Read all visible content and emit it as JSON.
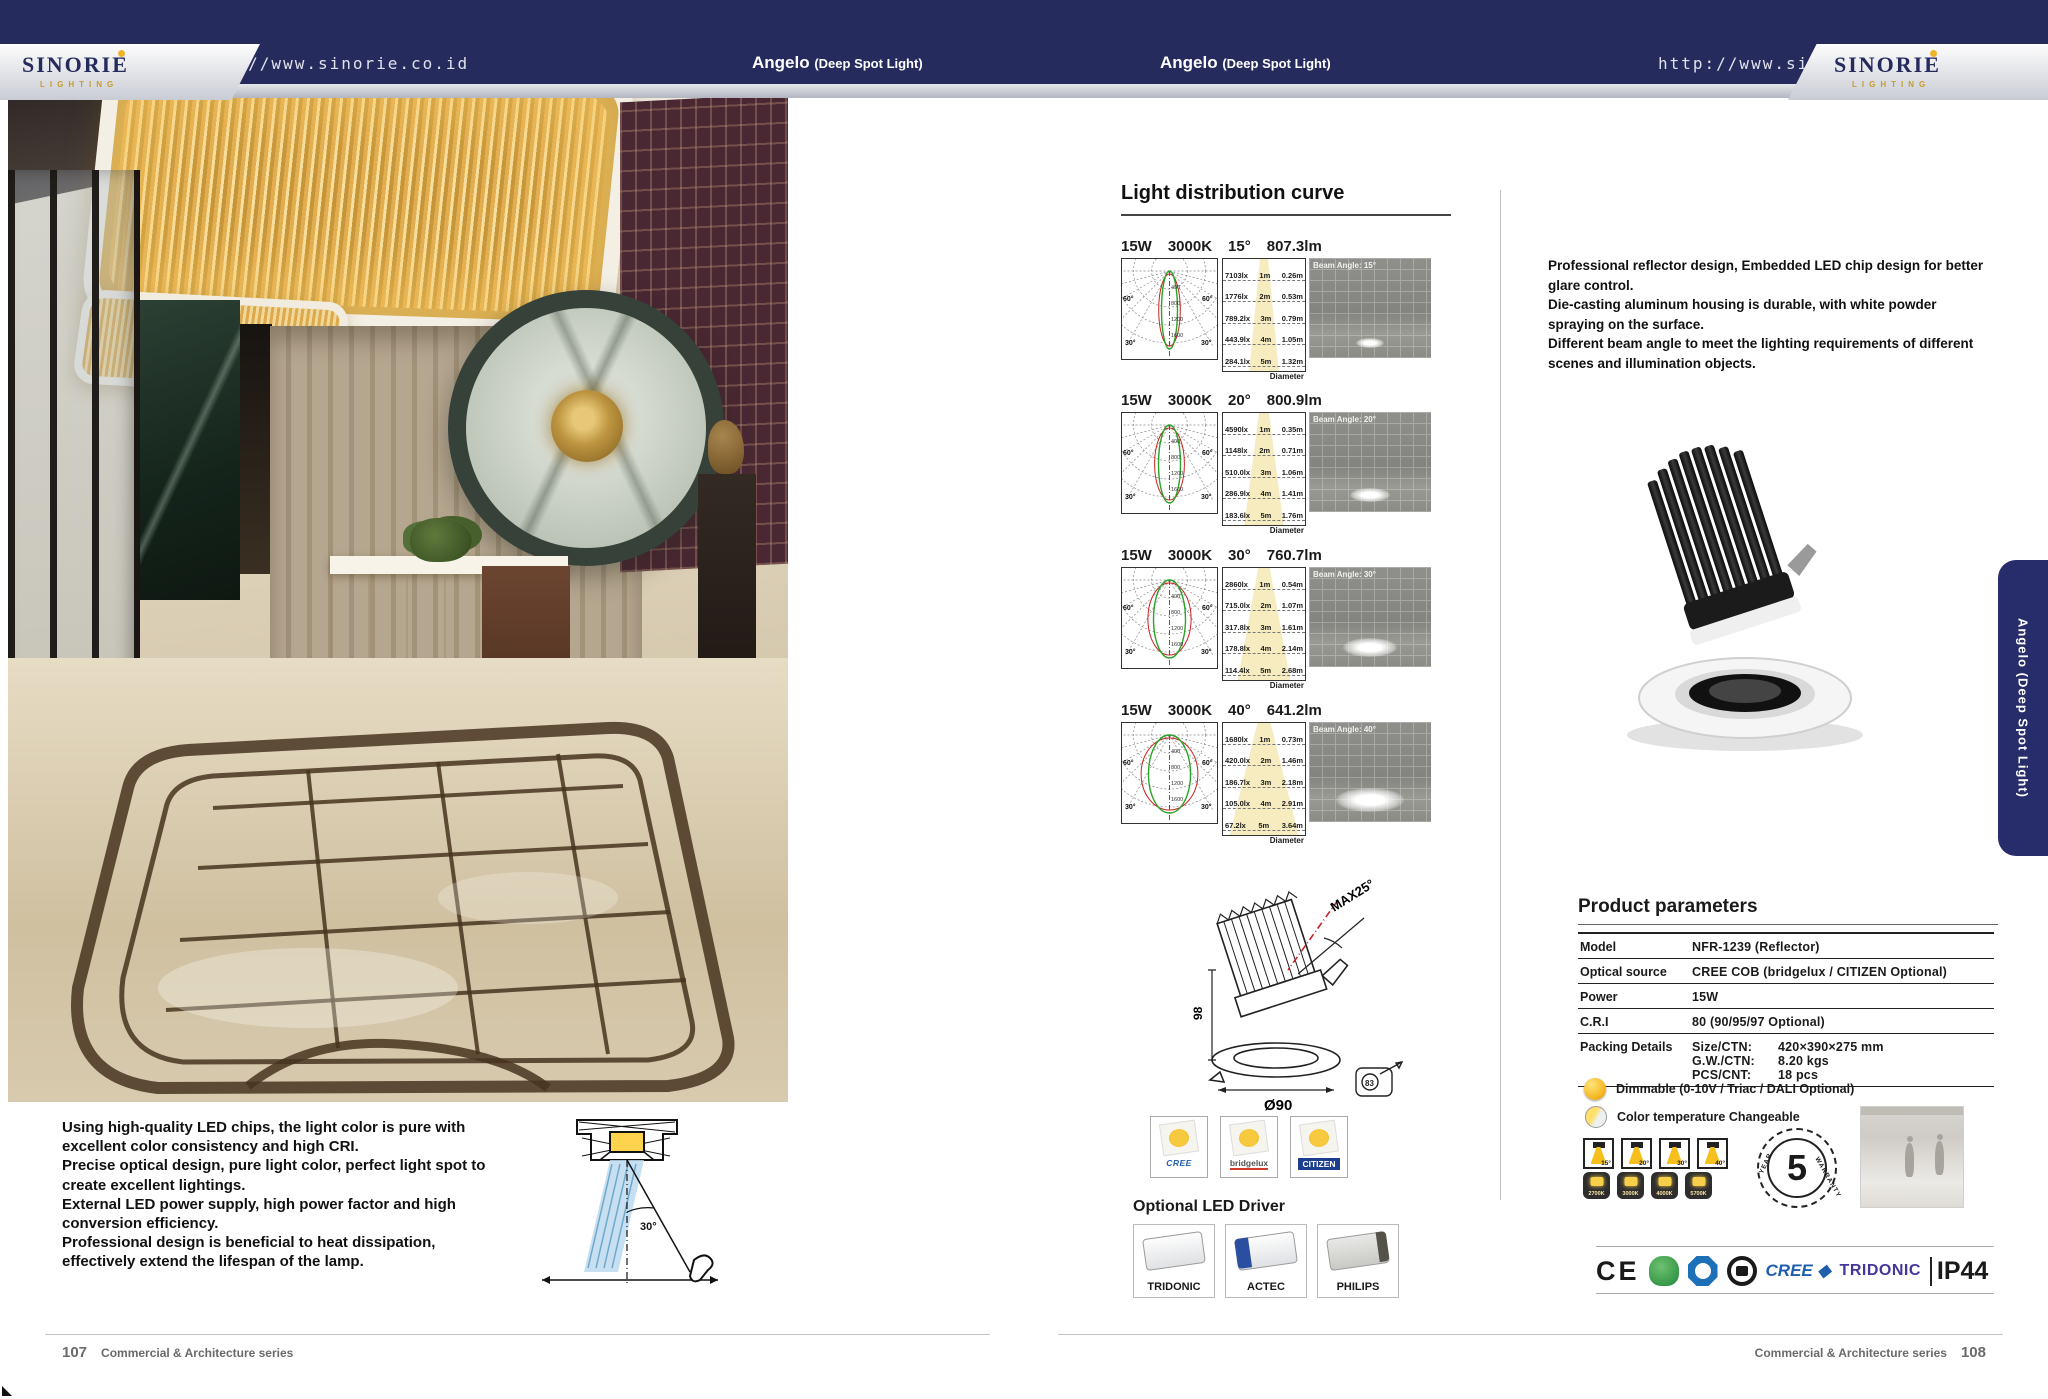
{
  "brand": {
    "name": "SINORIE",
    "tagline": "LIGHTING",
    "url": "http://www.sinorie.co.id"
  },
  "product": {
    "name": "Angelo",
    "type": "(Deep Spot Light)"
  },
  "side_tab": "Angelo (Deep Spot Light)",
  "footer": {
    "left_page_no": "107",
    "right_page_no": "108",
    "series": "Commercial & Architecture series"
  },
  "left_page": {
    "features": [
      "Using high-quality LED chips, the light color is pure with excellent color consistency and high CRI.",
      "Precise optical design, pure light color, perfect light spot to create excellent lightings.",
      "External LED power supply, high power factor and high conversion efficiency.",
      "Professional design is beneficial to heat dissipation, effectively extend the lifespan of the lamp."
    ],
    "glare_angle": "30°"
  },
  "distribution": {
    "title": "Light distribution curve",
    "diameter_label": "Diameter",
    "polar_ticks": [
      "400",
      "800",
      "1200",
      "1600"
    ],
    "polar_angle_labels": [
      "60°",
      "30°"
    ],
    "rows": [
      {
        "power": "15W",
        "cct": "3000K",
        "angle": "15°",
        "lumens": "807.3lm",
        "beam_label": "Beam Angle: 15°",
        "cone_table": [
          [
            "7103lx",
            "1m",
            "0.26m"
          ],
          [
            "1776lx",
            "2m",
            "0.53m"
          ],
          [
            "789.2lx",
            "3m",
            "0.79m"
          ],
          [
            "443.9lx",
            "4m",
            "1.05m"
          ],
          [
            "284.1lx",
            "5m",
            "1.32m"
          ]
        ]
      },
      {
        "power": "15W",
        "cct": "3000K",
        "angle": "20°",
        "lumens": "800.9lm",
        "beam_label": "Beam Angle: 20°",
        "cone_table": [
          [
            "4590lx",
            "1m",
            "0.35m"
          ],
          [
            "1148lx",
            "2m",
            "0.71m"
          ],
          [
            "510.0lx",
            "3m",
            "1.06m"
          ],
          [
            "286.9lx",
            "4m",
            "1.41m"
          ],
          [
            "183.6lx",
            "5m",
            "1.76m"
          ]
        ]
      },
      {
        "power": "15W",
        "cct": "3000K",
        "angle": "30°",
        "lumens": "760.7lm",
        "beam_label": "Beam Angle: 30°",
        "cone_table": [
          [
            "2860lx",
            "1m",
            "0.54m"
          ],
          [
            "715.0lx",
            "2m",
            "1.07m"
          ],
          [
            "317.8lx",
            "3m",
            "1.61m"
          ],
          [
            "178.8lx",
            "4m",
            "2.14m"
          ],
          [
            "114.4lx",
            "5m",
            "2.68m"
          ]
        ]
      },
      {
        "power": "15W",
        "cct": "3000K",
        "angle": "40°",
        "lumens": "641.2lm",
        "beam_label": "Beam Angle: 40°",
        "cone_table": [
          [
            "1680lx",
            "1m",
            "0.73m"
          ],
          [
            "420.0lx",
            "2m",
            "1.46m"
          ],
          [
            "186.7lx",
            "3m",
            "2.18m"
          ],
          [
            "105.0lx",
            "4m",
            "2.91m"
          ],
          [
            "67.2lx",
            "5m",
            "3.64m"
          ]
        ]
      }
    ]
  },
  "description": [
    "Professional reflector design, Embedded LED chip design for better glare control.",
    "Die-casting aluminum housing is durable, with white powder spraying on the surface.",
    "Different beam angle to meet the lighting requirements of different scenes and illumination objects."
  ],
  "parameters": {
    "title": "Product parameters",
    "rows": [
      {
        "label": "Model",
        "value": "NFR-1239  (Reflector)"
      },
      {
        "label": "Optical source",
        "value": "CREE COB (bridgelux / CITIZEN Optional)"
      },
      {
        "label": "Power",
        "value": "15W"
      },
      {
        "label": "C.R.I",
        "value": "80 (90/95/97 Optional)"
      }
    ],
    "packing": {
      "label": "Packing Details",
      "lines": [
        [
          "Size/CTN:",
          "420×390×275 mm"
        ],
        [
          "G.W./CTN:",
          "8.20 kgs"
        ],
        [
          "PCS/CNT:",
          "18 pcs"
        ]
      ]
    }
  },
  "options": {
    "dimmable": "Dimmable (0-10V / Triac / DALI Optional)",
    "cct_changeable": "Color temperature Changeable",
    "beam_icons": [
      "15°",
      "20°",
      "30°",
      "40°"
    ],
    "cct_icons": [
      "2700K",
      "3000K",
      "4000K",
      "5700K"
    ],
    "warranty_years": "5",
    "warranty_text_top": "YEAR",
    "warranty_text_bottom": "WARRANTY"
  },
  "dimensions": {
    "max_tilt": "MAX25°",
    "height": "98",
    "diameter": "Ø90",
    "cutout": "83"
  },
  "chips": [
    "CREE",
    "bridgelux",
    "CITIZEN"
  ],
  "drivers": {
    "title": "Optional LED Driver",
    "brands": [
      "TRIDONIC",
      "ACTEC",
      "PHILIPS"
    ]
  },
  "certs": {
    "ce": "CE",
    "cree": "CREE ◆",
    "tridonic": "TRIDONIC",
    "ip": "IP44"
  },
  "colors": {
    "navy": "#262b5e",
    "gold": "#f0b429",
    "cree_blue": "#1f5fae",
    "tridonic_purple": "#43379c"
  }
}
